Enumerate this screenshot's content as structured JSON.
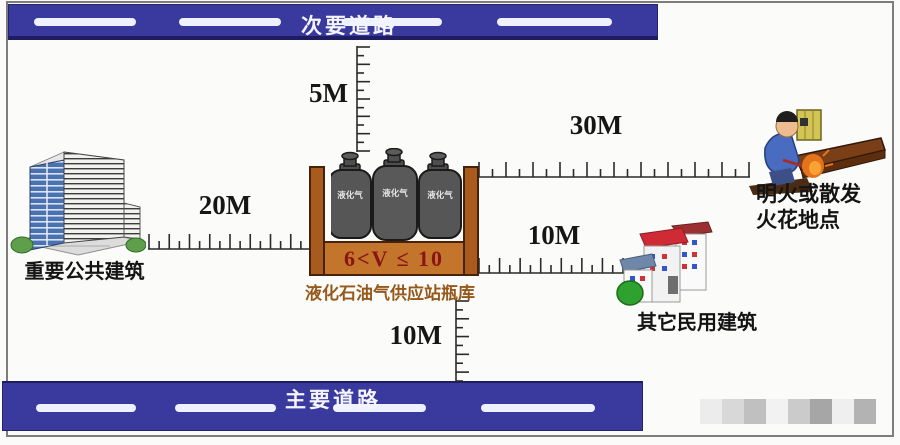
{
  "roads": {
    "secondary": "次要道路",
    "primary": "主要道路"
  },
  "labels": {
    "public_building": "重要公共建筑",
    "flame_line1": "明火或散发",
    "flame_line2": "火花地点",
    "civilian_building": "其它民用建筑",
    "station_name": "液化石油气供应站瓶库",
    "volume_range": "6<V ≤ 10",
    "cylinder": "液化气"
  },
  "distances": {
    "to_secondary_road": "5M",
    "to_public_building": "20M",
    "to_flame_site": "30M",
    "to_civilian_building": "10M",
    "to_primary_road": "10M"
  },
  "colors": {
    "road": "#3a3a9e",
    "road_border": "#1d1d60",
    "container_wall": "#a95a1f",
    "container_base": "#c4752c",
    "volume_text": "#8a1414",
    "station_text": "#96591b"
  },
  "watermark_blocks": [
    "#ececec",
    "#d8d8d8",
    "#c0c0c0",
    "#f2f2f2",
    "#cbcbcb",
    "#a6a6a6",
    "#efefef",
    "#b3b3b3"
  ]
}
